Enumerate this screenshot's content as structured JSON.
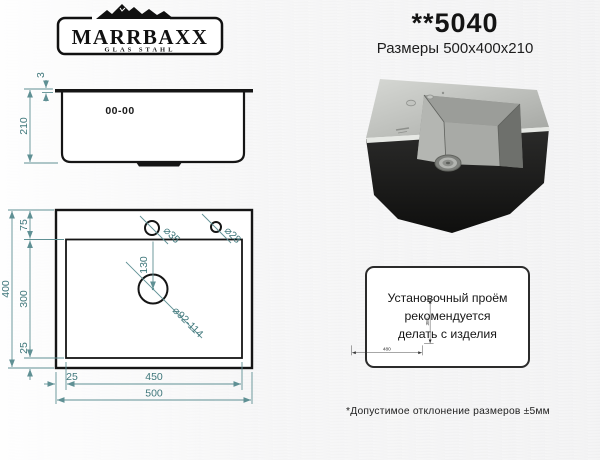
{
  "logo": {
    "brand": "MARRBAXX",
    "tagline": "GLAS STAHL"
  },
  "header": {
    "model": "**5040",
    "size_line": "Размеры 500x400x210"
  },
  "side_view": {
    "marking": "00-00",
    "rim_dim": "3",
    "depth_dim": "210"
  },
  "top_view": {
    "height_total": "400",
    "margin_top": "75",
    "height_bowl": "300",
    "margin_bottom": "25",
    "margin_left": "25",
    "width_bowl": "450",
    "width_total": "500",
    "hole_faucet": "⌀35",
    "hole_soap": "⌀28",
    "drain_offset": "130",
    "drain_dia": "⌀92-114"
  },
  "install": {
    "note": [
      "Установочный проём",
      "рекомендуется",
      "делать с изделия"
    ],
    "cutout_height": "380",
    "cutout_width": "480",
    "footnote": "*Допустимое отклонение размеров ±5мм"
  },
  "colors": {
    "outline": "#151515",
    "dim_line": "#5f9094",
    "dim_text": "#3f777b",
    "dim_dark": "#333333",
    "steel_light": "#cfd1cd",
    "steel_dark": "#6e706c",
    "body_black": "#181817"
  }
}
